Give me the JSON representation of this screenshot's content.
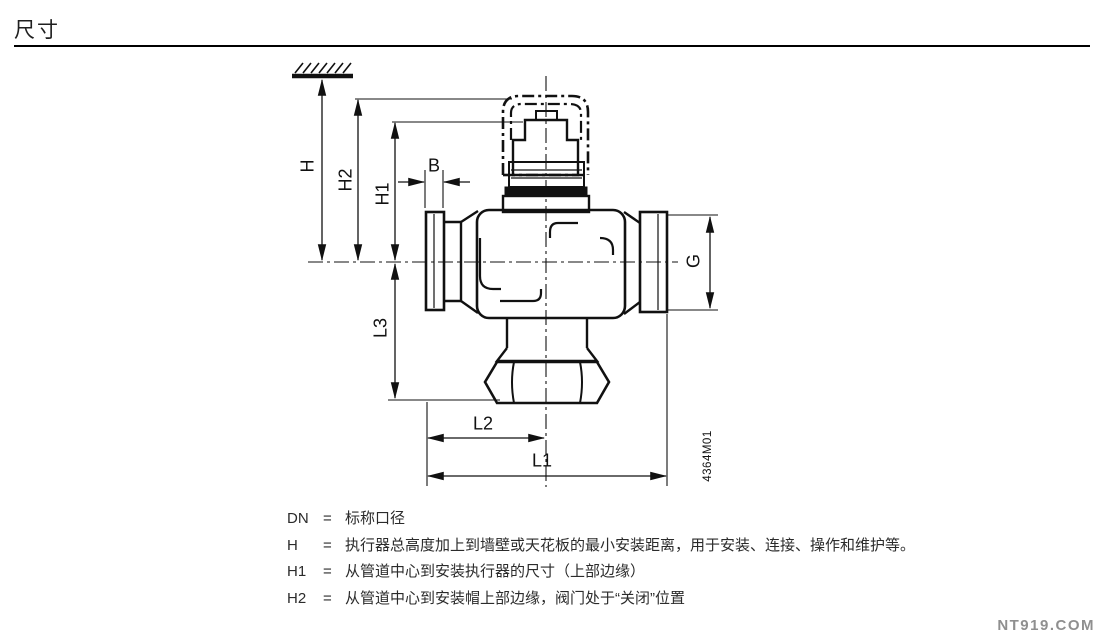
{
  "page": {
    "title": "尺寸",
    "watermark": "NT919.COM"
  },
  "drawing": {
    "code": "4364M01",
    "dimension_labels": {
      "h": "H",
      "h2": "H2",
      "h1": "H1",
      "b": "B",
      "g": "G",
      "l3": "L3",
      "l2": "L2",
      "l1": "L1"
    }
  },
  "legend": {
    "rows": [
      {
        "symbol": "DN",
        "eq": "=",
        "text": "标称口径"
      },
      {
        "symbol": "H",
        "eq": "=",
        "text": "执行器总高度加上到墙壁或天花板的最小安装距离，用于安装、连接、操作和维护等。"
      },
      {
        "symbol": "H1",
        "eq": "=",
        "text": "从管道中心到安装执行器的尺寸（上部边缘）"
      },
      {
        "symbol": "H2",
        "eq": "=",
        "text": "从管道中心到安装帽上部边缘，阀门处于“关闭”位置"
      }
    ]
  }
}
